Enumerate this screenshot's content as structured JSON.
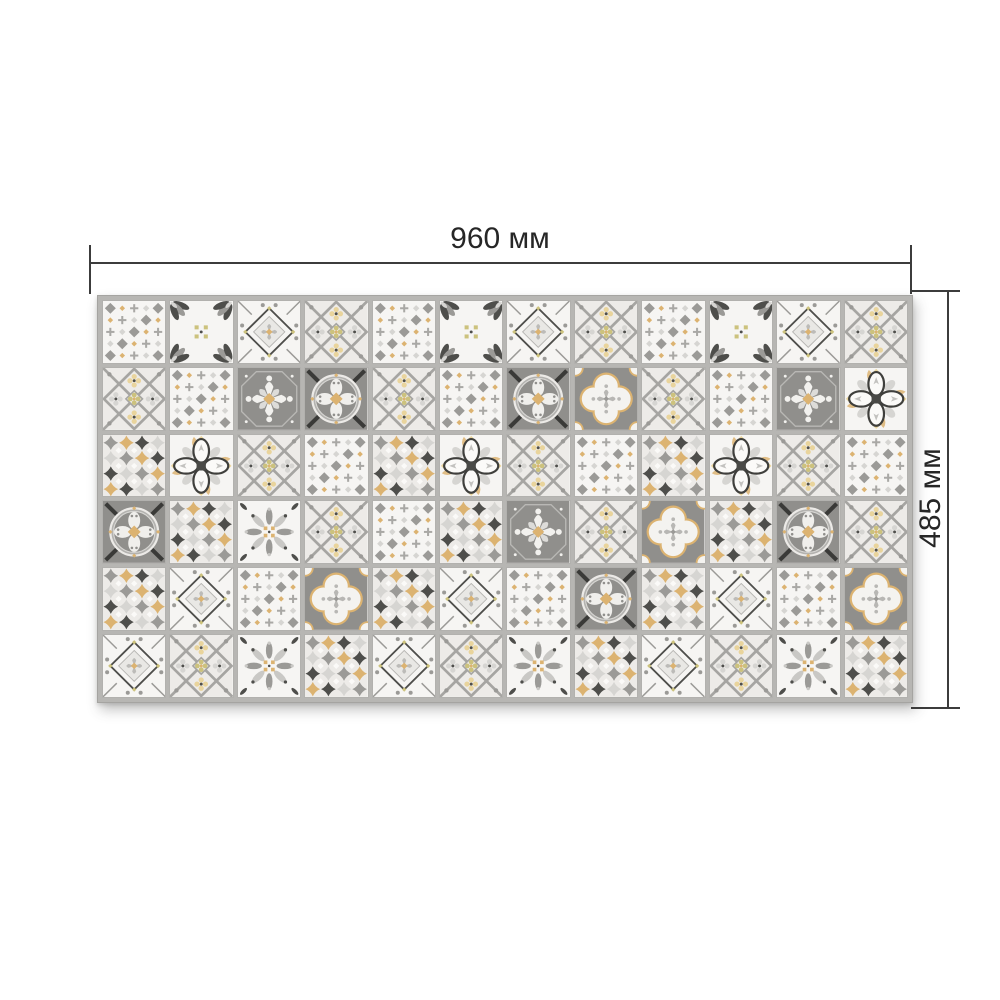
{
  "diagram": {
    "type": "product-dimension-drawing",
    "dimensions": {
      "width_label": "960 мм",
      "height_label": "485 мм"
    },
    "annotation": {
      "line_color": "#3c3c3c",
      "text_color": "#262626"
    }
  },
  "panel": {
    "columns": 12,
    "rows": 6,
    "grid": [
      "ABCDABCDABCD",
      "DAEFDAFGDAEI",
      "HIDAHIDAHIDA",
      "FHJDAHEDGHFD",
      "HCAGHCAFHCAG",
      "CDJHCDJHCDJH"
    ],
    "tile_types": {
      "A": "diamond-dots",
      "B": "corner-scrolls",
      "C": "diamond-frame",
      "D": "lattice-rosette",
      "E": "rosette-medallion",
      "F": "circle-medallion",
      "G": "quatrefoil-medallion",
      "H": "mosaic-stars",
      "I": "clover-flower",
      "J": "scroll-cross"
    },
    "palette": {
      "grout": "#b7b6b3",
      "tile_white": "#f6f5f3",
      "off_white": "#edebe8",
      "light_gray": "#d6d5d2",
      "mid_gray": "#9b9a97",
      "tile_gray_bg": "#908f8c",
      "dark_gray": "#4e4e4b",
      "near_black": "#3a3a38",
      "gold": "#dcb371",
      "pale_gold": "#e9d49c",
      "olive": "#ccc27d"
    }
  }
}
